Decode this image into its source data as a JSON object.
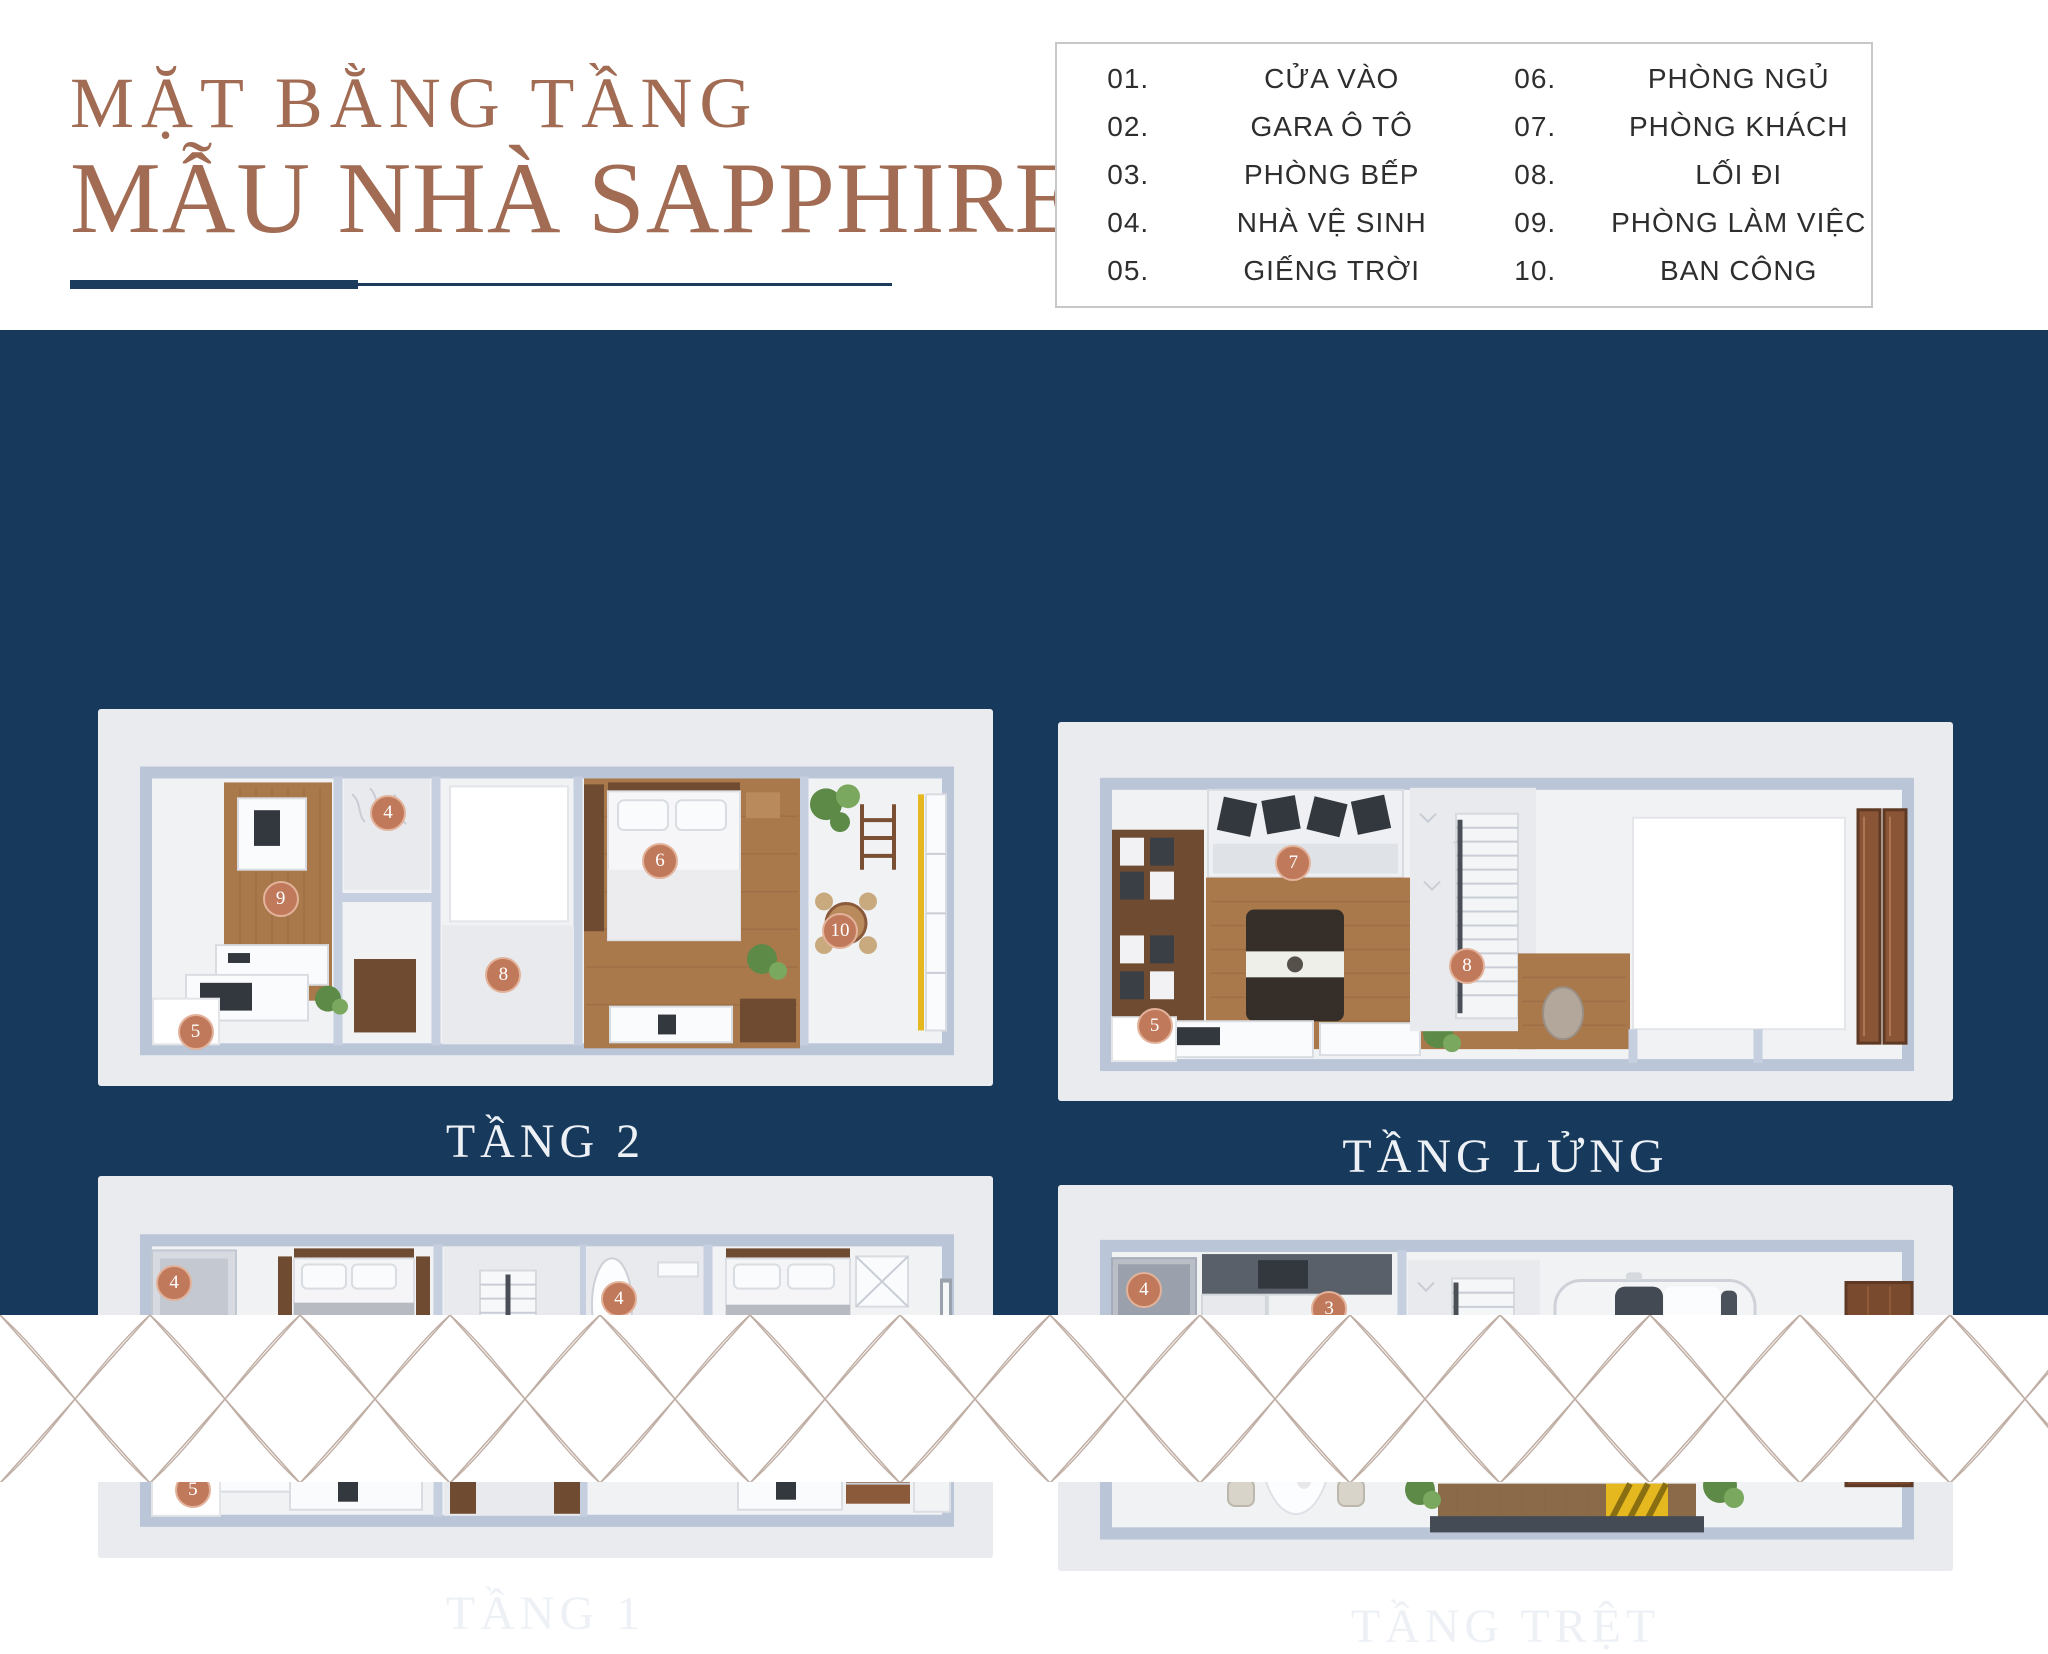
{
  "title": {
    "line1": "MẶT BẰNG TẦNG",
    "line2": "MẪU NHÀ SAPPHIRE"
  },
  "legend": {
    "items_left": [
      {
        "num": "01.",
        "label": "CỬA VÀO"
      },
      {
        "num": "02.",
        "label": "GARA Ô TÔ"
      },
      {
        "num": "03.",
        "label": "PHÒNG BẾP"
      },
      {
        "num": "04.",
        "label": "NHÀ VỆ SINH"
      },
      {
        "num": "05.",
        "label": "GIẾNG TRỜI"
      }
    ],
    "items_right": [
      {
        "num": "06.",
        "label": "PHÒNG NGỦ"
      },
      {
        "num": "07.",
        "label": "PHÒNG KHÁCH"
      },
      {
        "num": "08.",
        "label": "LỐI ĐI"
      },
      {
        "num": "09.",
        "label": "PHÒNG LÀM VIỆC"
      },
      {
        "num": "10.",
        "label": "BAN CÔNG"
      }
    ]
  },
  "floors": [
    {
      "id": "tang-2",
      "label": "TẦNG 2",
      "badges": [
        {
          "n": "4",
          "x": 32.4,
          "y": 27.7
        },
        {
          "n": "9",
          "x": 20.4,
          "y": 50.3
        },
        {
          "n": "6",
          "x": 62.8,
          "y": 40.4
        },
        {
          "n": "8",
          "x": 45.3,
          "y": 70.5
        },
        {
          "n": "5",
          "x": 10.9,
          "y": 85.6
        },
        {
          "n": "10",
          "x": 82.9,
          "y": 59.0
        }
      ]
    },
    {
      "id": "tang-lung",
      "label": "TẦNG LỬNG",
      "badges": [
        {
          "n": "7",
          "x": 26.3,
          "y": 37.2
        },
        {
          "n": "8",
          "x": 45.7,
          "y": 64.4
        },
        {
          "n": "5",
          "x": 10.8,
          "y": 80.2
        }
      ]
    },
    {
      "id": "tang-1",
      "label": "TẦNG 1",
      "badges": [
        {
          "n": "4",
          "x": 8.5,
          "y": 28.0
        },
        {
          "n": "6",
          "x": 27.3,
          "y": 47.1
        },
        {
          "n": "4",
          "x": 58.2,
          "y": 32.2
        },
        {
          "n": "6",
          "x": 76.2,
          "y": 51.0
        },
        {
          "n": "8",
          "x": 45.3,
          "y": 68.3
        },
        {
          "n": "5",
          "x": 10.6,
          "y": 82.2
        }
      ]
    },
    {
      "id": "tang-tret",
      "label": "TẦNG TRỆT",
      "badges": [
        {
          "n": "4",
          "x": 9.6,
          "y": 27.2
        },
        {
          "n": "3",
          "x": 30.3,
          "y": 32.1
        },
        {
          "n": "2",
          "x": 67.0,
          "y": 39.9
        },
        {
          "n": "1",
          "x": 90.4,
          "y": 48.4
        }
      ]
    }
  ],
  "colors": {
    "navy": "#16395c",
    "copper": "#c1795c",
    "title_brown": "#a16c53",
    "wood": "#a9794c",
    "accent_yellow": "#e4b81e"
  }
}
